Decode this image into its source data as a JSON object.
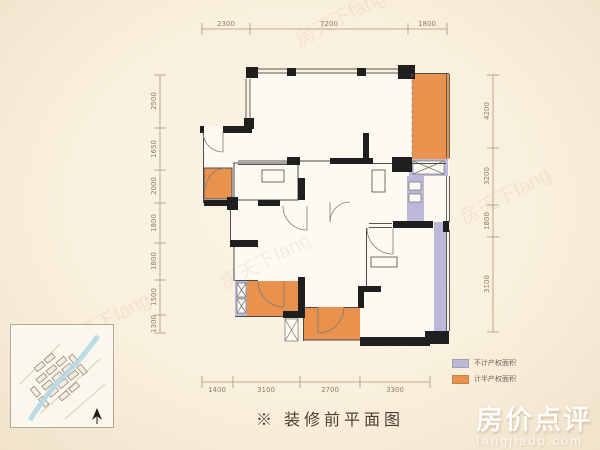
{
  "page": {
    "background": "#f9f1e0",
    "caption": "※ 装修前平面图"
  },
  "colors": {
    "half_area_orange": "#e8924e",
    "no_area_purple": "#bdb7da",
    "wall_black": "#1f1f1f"
  },
  "dimensions": {
    "top": [
      "2300",
      "7200",
      "1800"
    ],
    "bottom": [
      "1400",
      "3100",
      "2700",
      "3300"
    ],
    "left": [
      "2500",
      "1650",
      "2000",
      "1800",
      "1800",
      "1500",
      "1300"
    ],
    "right": [
      "4200",
      "3200",
      "1800",
      "3100"
    ]
  },
  "legend": {
    "items": [
      {
        "label": "不计产权面积",
        "color": "#bdb7da"
      },
      {
        "label": "计半产权面积",
        "color": "#e8924e"
      }
    ]
  },
  "watermarks": {
    "brand": "房价点评",
    "brand_domain": "fangjiadp.com",
    "diagonal": "房天下fang"
  }
}
